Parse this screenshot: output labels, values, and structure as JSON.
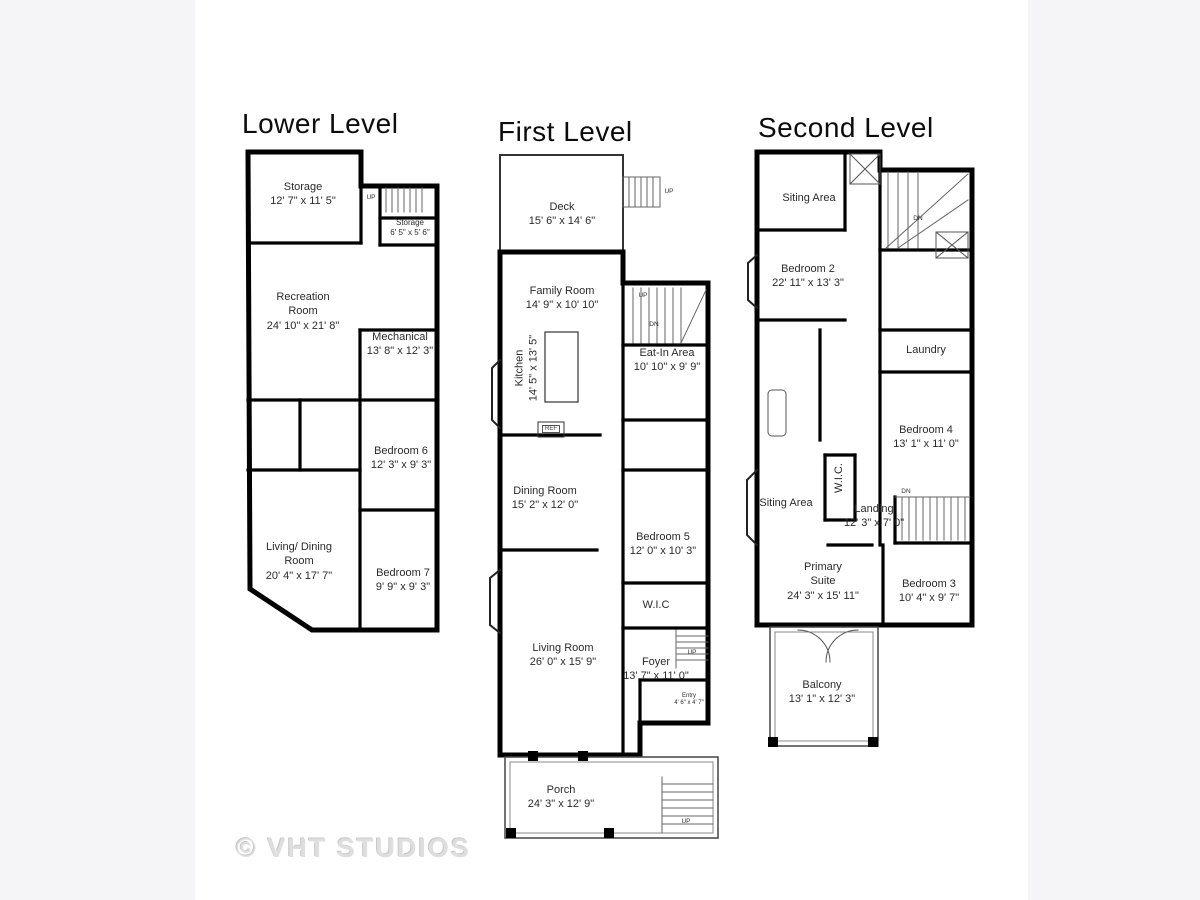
{
  "page": {
    "watermark": "© VHT STUDIOS",
    "colors": {
      "background": "#f5f4f6",
      "canvas": "#ffffff",
      "wall": "#000000",
      "label": "#2b2b2b",
      "watermark": "#dedede"
    }
  },
  "levels": [
    {
      "title": "Lower Level",
      "rooms": [
        {
          "name": "Storage",
          "dims": "12' 7\" x 11' 5\""
        },
        {
          "name": "Storage",
          "dims": "6' 5\" x 5' 6\""
        },
        {
          "name": "Recreation Room",
          "dims": "24' 10\" x 21' 8\""
        },
        {
          "name": "Mechanical",
          "dims": "13' 8\" x 12' 3\""
        },
        {
          "name": "Bedroom 6",
          "dims": "12' 3\" x 9' 3\""
        },
        {
          "name": "Living/ Dining Room",
          "dims": "20' 4\" x 17' 7\""
        },
        {
          "name": "Bedroom 7",
          "dims": "9' 9\" x 9' 3\""
        }
      ],
      "small_labels": [
        {
          "text": "UP"
        }
      ]
    },
    {
      "title": "First Level",
      "rooms": [
        {
          "name": "Deck",
          "dims": "15' 6\" x 14' 6\""
        },
        {
          "name": "Family Room",
          "dims": "14' 9\" x 10' 10\""
        },
        {
          "name": "Kitchen",
          "dims": "14' 5\" x 13' 5\""
        },
        {
          "name": "Eat-In Area",
          "dims": "10' 10\" x 9' 9\""
        },
        {
          "name": "Dining Room",
          "dims": "15' 2\" x 12' 0\""
        },
        {
          "name": "Bedroom 5",
          "dims": "12' 0\" x 10' 3\""
        },
        {
          "name": "W.I.C",
          "dims": ""
        },
        {
          "name": "Living Room",
          "dims": "26' 0\" x 15' 9\""
        },
        {
          "name": "Foyer",
          "dims": "13' 7\" x 11' 0\""
        },
        {
          "name": "Entry",
          "dims": "4' 6\" x 4' 7\""
        },
        {
          "name": "Porch",
          "dims": "24' 3\" x 12' 9\""
        }
      ],
      "small_labels": [
        {
          "text": "UP"
        },
        {
          "text": "UP"
        },
        {
          "text": "DN"
        },
        {
          "text": "UP"
        },
        {
          "text": "UP"
        },
        {
          "text": "REF"
        }
      ]
    },
    {
      "title": "Second Level",
      "rooms": [
        {
          "name": "Siting Area",
          "dims": ""
        },
        {
          "name": "Bedroom 2",
          "dims": "22' 11\" x 13' 3\""
        },
        {
          "name": "Laundry",
          "dims": ""
        },
        {
          "name": "Bedroom 4",
          "dims": "13' 1\" x 11' 0\""
        },
        {
          "name": "Siting Area",
          "dims": ""
        },
        {
          "name": "W.I.C.",
          "dims": ""
        },
        {
          "name": "Landing",
          "dims": "12' 3\" x 7' 0\""
        },
        {
          "name": "Primary Suite",
          "dims": "24' 3\" x 15' 11\""
        },
        {
          "name": "Bedroom 3",
          "dims": "10' 4\" x 9' 7\""
        },
        {
          "name": "Balcony",
          "dims": "13' 1\" x 12' 3\""
        }
      ],
      "small_labels": [
        {
          "text": "DN"
        },
        {
          "text": "DN"
        }
      ]
    }
  ]
}
